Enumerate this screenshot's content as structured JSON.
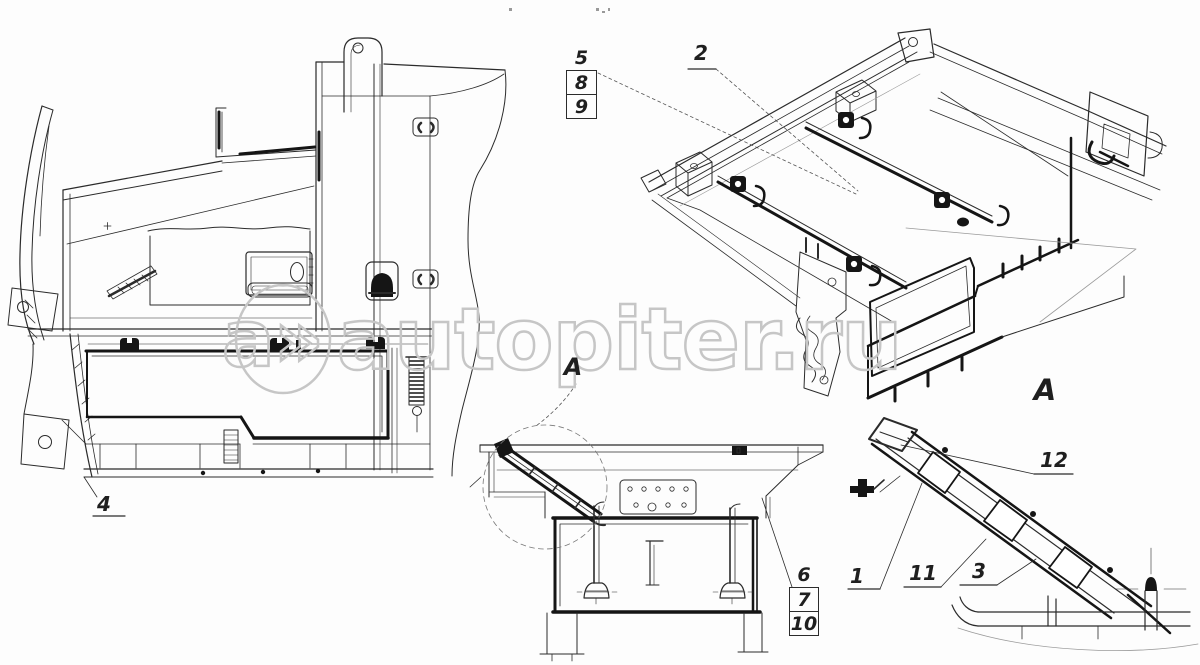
{
  "watermark": {
    "prefix": "a»",
    "domain": "autopiter.ru"
  },
  "callouts": {
    "left_view_part": "4",
    "iso_view_part": "2",
    "iso_stack": [
      "5",
      "8",
      "9"
    ],
    "section_stack": [
      "6",
      "7",
      "10"
    ],
    "section_view_marker": "A",
    "detail_view_title": "A",
    "detail_labels": {
      "n12": "12",
      "n1": "1",
      "n11": "11",
      "n3": "3"
    }
  },
  "colors": {
    "ink": "#2b2b2b",
    "accent_dark": "#151515",
    "watermark": "#c6c6c6",
    "background": "#ffffff"
  }
}
